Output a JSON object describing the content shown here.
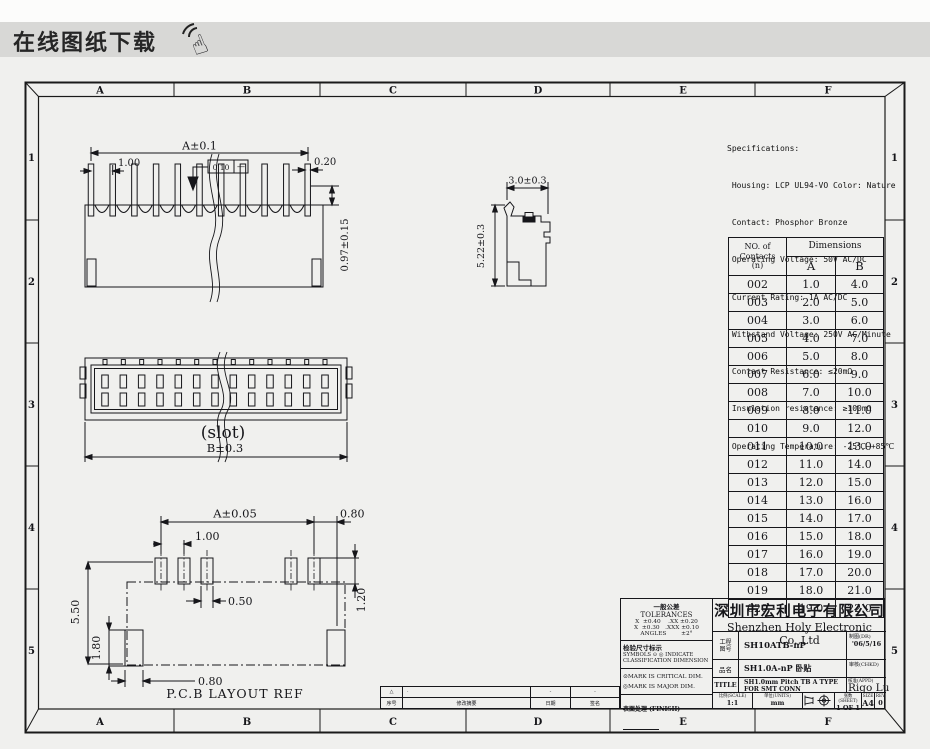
{
  "banner": {
    "title": "在线图纸下载"
  },
  "frame": {
    "cols": [
      "A",
      "B",
      "C",
      "D",
      "E",
      "F"
    ],
    "rows": [
      "1",
      "2",
      "3",
      "4",
      "5"
    ]
  },
  "specs": {
    "lines": [
      "Specifications:",
      " Housing: LCP UL94-VO Color: Nature",
      " Contact: Phosphor Bronze",
      " Operating Voltage: 50V AC/DC",
      " Current Rating: 1A AC/DC",
      " Withstand Voltage: 250V AC/Minute",
      " Contact Resistance: ≤20mΩ",
      " Insulation resistance: ≥100mΩ",
      " Operating Temperature: -25℃~+85℃"
    ]
  },
  "contacts_table": {
    "header": {
      "col1_l1": "NO. of",
      "col1_l2": "Contacts",
      "col1_l3": "(n)",
      "dims": "Dimensions",
      "a": "A",
      "b": "B"
    },
    "rows": [
      {
        "n": "002",
        "a": "1.0",
        "b": "4.0"
      },
      {
        "n": "003",
        "a": "2.0",
        "b": "5.0"
      },
      {
        "n": "004",
        "a": "3.0",
        "b": "6.0"
      },
      {
        "n": "005",
        "a": "4.0",
        "b": "7.0"
      },
      {
        "n": "006",
        "a": "5.0",
        "b": "8.0"
      },
      {
        "n": "007",
        "a": "6.0",
        "b": "9.0"
      },
      {
        "n": "008",
        "a": "7.0",
        "b": "10.0"
      },
      {
        "n": "009",
        "a": "8.0",
        "b": "11.0"
      },
      {
        "n": "010",
        "a": "9.0",
        "b": "12.0"
      },
      {
        "n": "011",
        "a": "10.0",
        "b": "13.0"
      },
      {
        "n": "012",
        "a": "11.0",
        "b": "14.0"
      },
      {
        "n": "013",
        "a": "12.0",
        "b": "15.0"
      },
      {
        "n": "014",
        "a": "13.0",
        "b": "16.0"
      },
      {
        "n": "015",
        "a": "14.0",
        "b": "17.0"
      },
      {
        "n": "016",
        "a": "15.0",
        "b": "18.0"
      },
      {
        "n": "017",
        "a": "16.0",
        "b": "19.0"
      },
      {
        "n": "018",
        "a": "17.0",
        "b": "20.0"
      },
      {
        "n": "019",
        "a": "18.0",
        "b": "21.0"
      },
      {
        "n": "020",
        "a": "19.0",
        "b": "22.0"
      }
    ]
  },
  "views": {
    "top": {
      "overall": "A±0.1",
      "pitch": "1.00",
      "pin_width": "0.20",
      "height": "0.97±0.15",
      "flatness": "0.10",
      "flatness_datum": "—"
    },
    "front": {
      "caption": "(slot)",
      "width": "B±0.3"
    },
    "side": {
      "width": "3.0±0.3",
      "height": "5.22±0.3"
    },
    "pcb": {
      "span": "A±0.05",
      "end_gap": "0.80",
      "pitch": "1.00",
      "pad_width": "0.50",
      "pad_length": "1.20",
      "height": "5.50",
      "corner_pad_height": "1.80",
      "corner_pad_width": "0.80",
      "caption": "P.C.B LAYOUT REF"
    }
  },
  "title_block": {
    "tolerances": {
      "cn": "一般公差",
      "en": "TOLERANCES",
      "line1": "X  ±0.40    .XX ±0.20",
      "line2": "X  ±0.30   .XXX ±0.10",
      "line3": "ANGLES        ±2°"
    },
    "inspection": {
      "cn": "检验尺寸标示",
      "l1": "SYMBOLS ⊙ ◎ INDICATE",
      "l2": "CLASSIFICATION DIMENSION",
      "critical": "⊙MARK IS CRITICAL DIM.",
      "major": "◎MARK IS MAJOR DIM."
    },
    "finish_label": "表面处理 (FINISH)",
    "company_cn": "深圳市宏利电子有限公司",
    "company_en": "Shenzhen Holy Electronic Co.,Ltd",
    "fields": {
      "drawing_no_label_l1": "工程",
      "drawing_no_label_l2": "图号",
      "drawing_no": "SH10ATB-nP",
      "part_name_label": "品名",
      "part_name": "SH1.0A-nP 卧贴",
      "title_label": "TITLE",
      "title_l1": "SH1.0mm Pitch TB A TYPE",
      "title_l2": "FOR SMT  CONN",
      "dr_label": "制图(DR)",
      "dr_value": "'06/5/16",
      "chkd_label": "审核(CHKD)",
      "chkd_value": "",
      "appd_label": "核准(APPD)",
      "appd_value": "Rigo Lu",
      "scale_label": "比例(SCALE)",
      "scale_value": "1:1",
      "units_label": "单位(UNITS)",
      "units_value": "mm",
      "sheet_label": "张数(SHEET)",
      "sheet_value": "1 OF 1",
      "size_label": "SIZE",
      "size_value": "A4",
      "rev_label": "REV",
      "rev_value": "0"
    },
    "revision_strip": {
      "rev_cn": "序号",
      "rev_en": "REV",
      "desc_cn": "修改摘要",
      "desc_en": "REVISION DESCRIPTIONS",
      "date_cn": "日期",
      "date_en": "DATE",
      "sign_cn": "签名",
      "sign_en": "SIGNATURE",
      "row": {
        "rev": "△",
        "desc": "·",
        "date": "-",
        "sign": "-"
      }
    }
  }
}
